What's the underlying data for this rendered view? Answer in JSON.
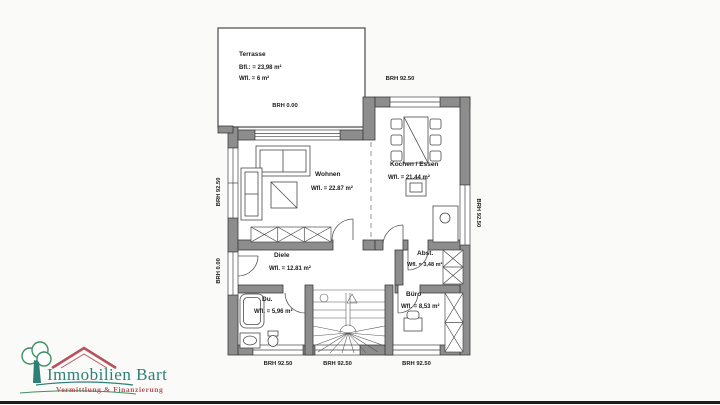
{
  "page": {
    "background": "#fafaf8"
  },
  "plan": {
    "rooms": {
      "terrasse": {
        "name": "Terrasse",
        "area1": "Bfl.: = 23,98 m²",
        "area2": "Wfl. = 6 m²"
      },
      "wohnen": {
        "name": "Wohnen",
        "area": "Wfl. = 22.87 m²"
      },
      "kochen_essen": {
        "name": "Kochen / Essen",
        "area": "Wfl. = 21.44 m²"
      },
      "diele": {
        "name": "Diele",
        "area": "Wfl. = 12.81 m²"
      },
      "abstellraum": {
        "name": "Abst.",
        "area": "Wfl. = 3,48 m²"
      },
      "buero": {
        "name": "Büro",
        "area": "Wfl. = 8,53 m²"
      },
      "dusche": {
        "name": "Du.",
        "area": "Wfl. = 5,96 m²"
      }
    },
    "sills": {
      "kitchen_top": "BRH 92.50",
      "terrace_door": "BRH 0.00",
      "left_window": "BRH 92.50",
      "left_door": "BRH 0.00",
      "right_window": "BRH 92.50",
      "bottom_du": "BRH 92.50",
      "bottom_stair": "BRH 92.50",
      "bottom_buero": "BRH 92.50"
    }
  },
  "logo": {
    "name": "Immobilien Bart",
    "tagline": "Vermittlung & Finanzierung",
    "colors": {
      "teal": "#2e8077",
      "red": "#b5525c",
      "green": "#3f8f63",
      "wall_gray": "#8d8d8d"
    }
  }
}
